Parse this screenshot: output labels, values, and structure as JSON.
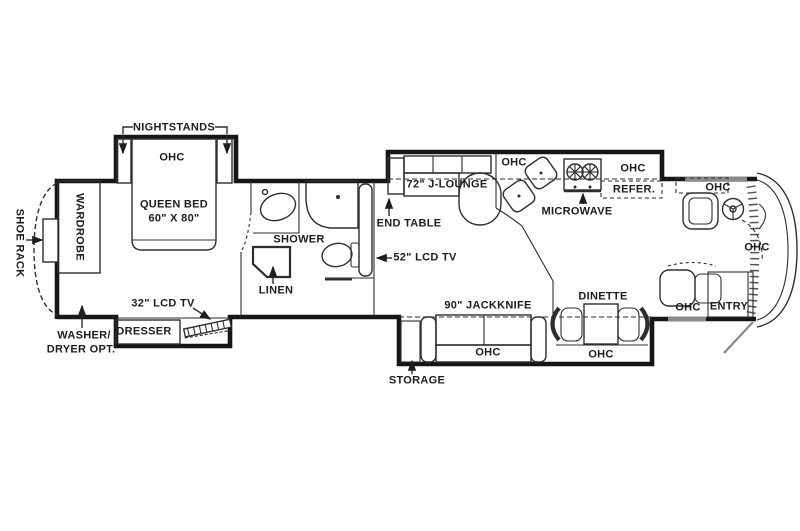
{
  "title": "RV floor plan",
  "colors": {
    "line": "#2e2e2e",
    "wall": "#161616",
    "window_gray": "#8a8a8a",
    "door_swing_gray": "#888888",
    "background": "#ffffff"
  },
  "labels": {
    "nightstands": "NIGHTSTANDS",
    "ohc": "OHC",
    "queen_bed": "QUEEN BED",
    "queen_bed_size": "60\" X 80\"",
    "shoe_rack": "SHOE RACK",
    "wardrobe": "WARDROBE",
    "washer_dryer_1": "WASHER/",
    "washer_dryer_2": "DRYER OPT.",
    "dresser": "DRESSER",
    "tv_32": "32\" LCD TV",
    "shower": "SHOWER",
    "linen": "LINEN",
    "end_table": "END TABLE",
    "tv_52": "52\" LCD TV",
    "j_lounge": "72\" J-LOUNGE",
    "microwave": "MICROWAVE",
    "refrigerator": "REFER.",
    "jackknife": "90\" JACKKNIFE",
    "dinette": "DINETTE",
    "entry": "ENTRY",
    "storage": "STORAGE"
  }
}
